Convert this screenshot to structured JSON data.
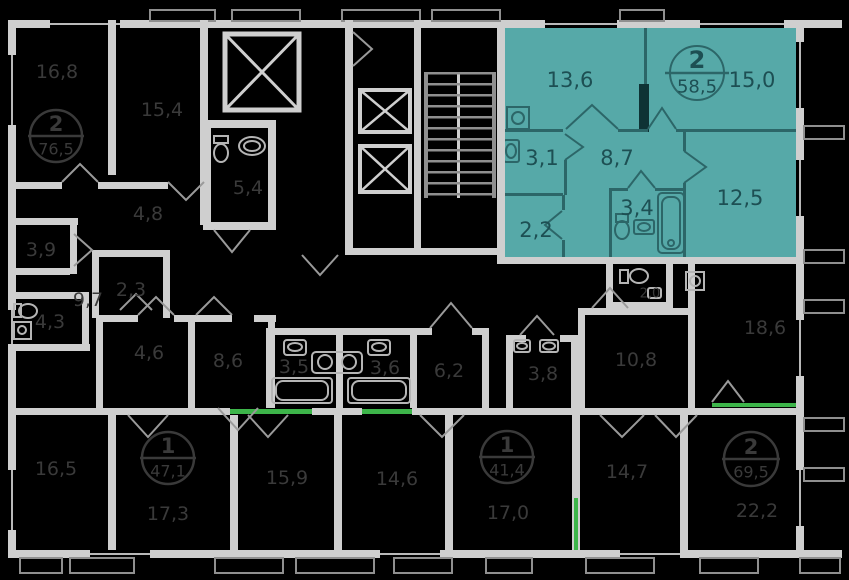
{
  "colors": {
    "background": "#000000",
    "wall": "#cfcfcf",
    "wall_dim": "#8f8f8f",
    "highlight": "#56a9a8",
    "highlight_line": "#2c6668",
    "highlight_text": "#1d4f53",
    "highlight_entry": "#45d5d2",
    "dim_text": "#3a3a3a",
    "green": "#3db54a"
  },
  "selected_unit": {
    "badge": {
      "rooms": "2",
      "area": "58,5"
    },
    "rooms": {
      "living1": "13,6",
      "living2": "15,0",
      "hall": "8,7",
      "wc": "3,1",
      "wardrobe": "2,2",
      "bath": "3,4",
      "living3": "12,5"
    }
  },
  "units": {
    "unit76": {
      "rooms": "2",
      "area": "76,5"
    },
    "unit47": {
      "rooms": "1",
      "area": "47,1"
    },
    "unit41": {
      "rooms": "1",
      "area": "41,4"
    },
    "unit69": {
      "rooms": "2",
      "area": "69,5"
    }
  },
  "rooms": {
    "r16_8": "16,8",
    "r15_4": "15,4",
    "r4_8": "4,8",
    "r5_4": "5,4",
    "r3_9": "3,9",
    "r2_3": "2,3",
    "r9_7": "9,7",
    "r4_3": "4,3",
    "r4_6": "4,6",
    "r8_6": "8,6",
    "r3_5": "3,5",
    "r3_6": "3,6",
    "r6_2": "6,2",
    "r3_8": "3,8",
    "r2_0": "2,0",
    "r10_8": "10,8",
    "r18_6": "18,6",
    "r16_5": "16,5",
    "r17_3": "17,3",
    "r15_9": "15,9",
    "r14_6": "14,6",
    "r17_0": "17,0",
    "r14_7": "14,7",
    "r22_2": "22,2"
  }
}
